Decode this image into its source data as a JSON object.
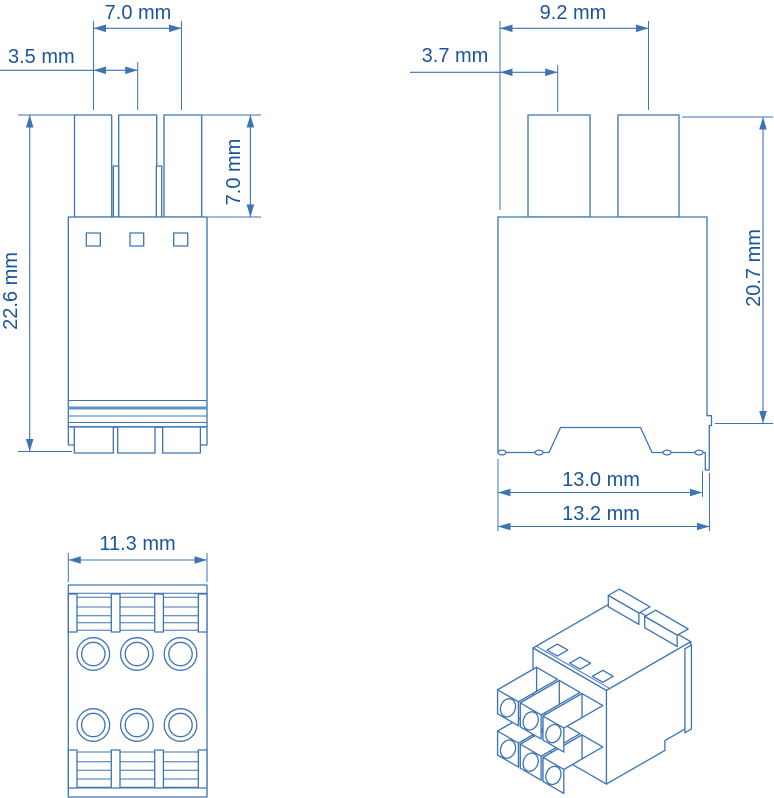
{
  "drawing": {
    "kind": "connector-dimension-drawing",
    "unit": "mm",
    "colors": {
      "line": "#3c74b4",
      "text": "#1b55a0",
      "band": "#5f93c8",
      "background": "#ffffff"
    },
    "front_view": {
      "pin_span": "7.0 mm",
      "pin_pitch": "3.5 mm",
      "pin_height": "7.0 mm",
      "overall_height": "22.6 mm"
    },
    "side_view": {
      "pin_span": "9.2 mm",
      "pin_offset": "3.7 mm",
      "body_height": "20.7 mm",
      "body_depth": "13.0 mm",
      "overall_depth": "13.2 mm"
    },
    "bottom_view": {
      "width": "11.3 mm"
    }
  }
}
